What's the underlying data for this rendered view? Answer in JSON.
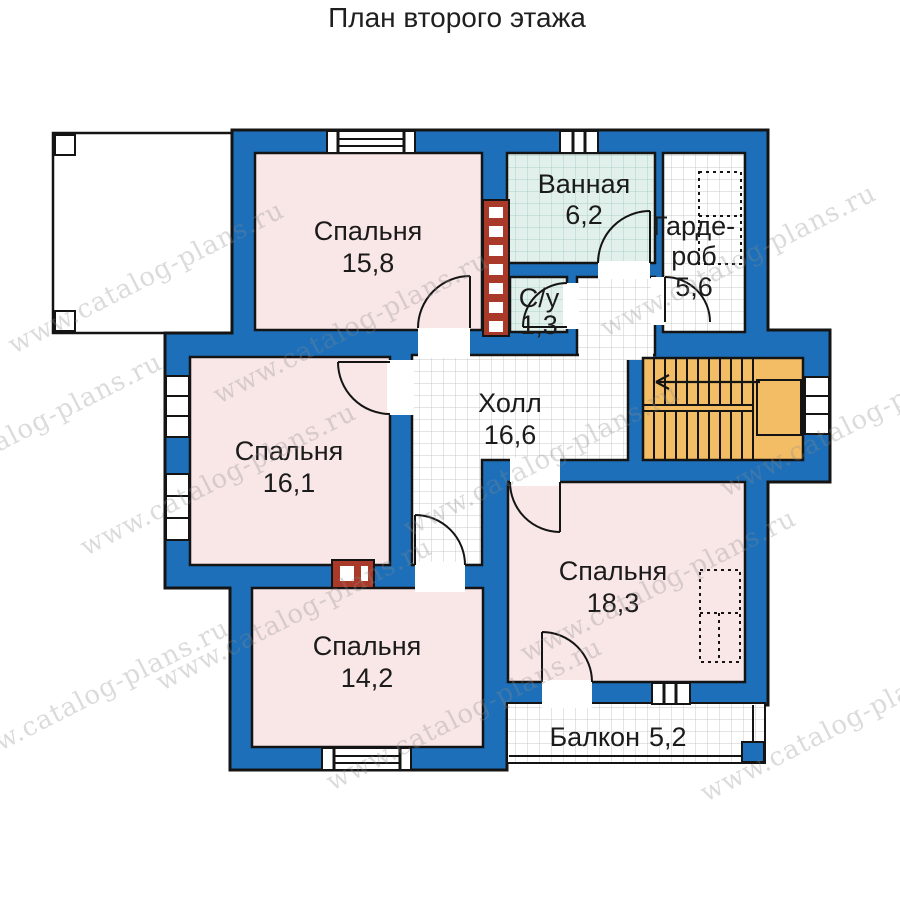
{
  "title": "План второго этажа",
  "watermark": {
    "text": "www.catalog-plans.ru"
  },
  "colors": {
    "wall": "#1c6fb8",
    "room_fill": "#f9e6e6",
    "bath_fill": "#e2f0ec",
    "stairs_fill": "#f2bd64",
    "vent_fill": "#a93a2a",
    "outline": "#141414",
    "grid_line": "#c9c9c9",
    "bath_grid_line": "#a9cfc8"
  },
  "rooms": {
    "bedroom_top": {
      "name": "Спальня",
      "area": "15,8"
    },
    "bathroom": {
      "name": "Ванная",
      "area": "6,2"
    },
    "wc": {
      "name": "С/у",
      "area": "1,3"
    },
    "wardrobe": {
      "line1": "Гарде-",
      "line2": "роб",
      "area": "5,6"
    },
    "hall": {
      "name": "Холл",
      "area": "16,6"
    },
    "bedroom_left": {
      "name": "Спальня",
      "area": "16,1"
    },
    "bedroom_right": {
      "name": "Спальня",
      "area": "18,3"
    },
    "bedroom_bottom": {
      "name": "Спальня",
      "area": "14,2"
    },
    "balcony": {
      "name": "Балкон",
      "area": "5,2"
    }
  }
}
